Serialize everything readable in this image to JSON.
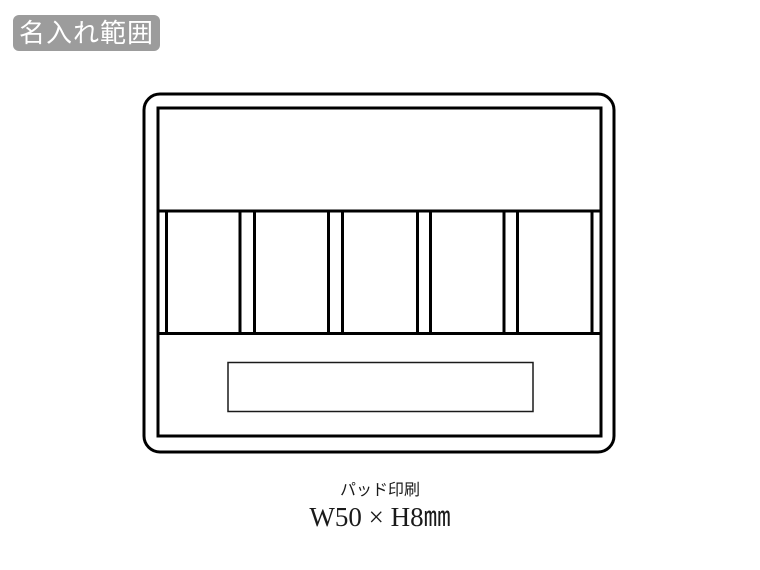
{
  "badge": {
    "label": "名入れ範囲",
    "bg_color": "#9c9c9c",
    "text_color": "#ffffff"
  },
  "diagram": {
    "kind": "product-front-outline-drawing",
    "line_color": "#000000",
    "compartment_count": 5,
    "print_area": {
      "fill": "#9fa0a0",
      "stroke": "#1a1a1a"
    }
  },
  "caption": {
    "method": "パッド印刷",
    "dimensions": "W50 × H8㎜"
  }
}
